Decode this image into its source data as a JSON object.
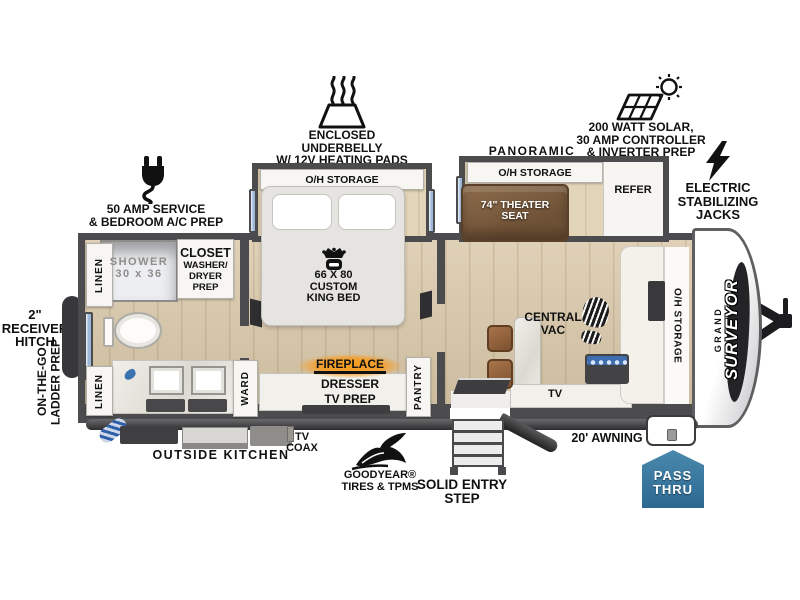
{
  "callouts": {
    "amp_service": {
      "l1": "50 AMP SERVICE",
      "l2": "& BEDROOM A/C PREP"
    },
    "underbelly": {
      "l1": "ENCLOSED UNDERBELLY",
      "l2": "W/ 12V HEATING PADS"
    },
    "solar": {
      "l1": "200 WATT SOLAR,",
      "l2": "30 AMP CONTROLLER",
      "l3": "& INVERTER PREP"
    },
    "panoramic_window": "PANORAMIC WINDOW",
    "stabilizing_jacks": {
      "l1": "ELECTRIC",
      "l2": "STABILIZING",
      "l3": "JACKS"
    },
    "receiver_hitch": {
      "l1": "2\" RECEIVER",
      "l2": "HITCH"
    },
    "ladder_prep": {
      "l1": "ON-THE-GO",
      "l2": "LADDER PREP"
    },
    "outside_kitchen": "OUTSIDE KITCHEN",
    "tv_coax": {
      "l1": "TV",
      "l2": "COAX"
    },
    "goodyear": {
      "l1": "GOODYEAR®",
      "l2": "TIRES & TPMS"
    },
    "entry_step": {
      "l1": "SOLID ENTRY",
      "l2": "STEP"
    },
    "awning": "20' AWNING",
    "pass_thru": {
      "l1": "PASS",
      "l2": "THRU"
    }
  },
  "bathroom": {
    "linen_top": "LINEN",
    "linen_bottom": "LINEN",
    "shower": {
      "l1": "SHOWER",
      "l2": "30 x 36"
    },
    "closet": {
      "l1": "CLOSET",
      "l2": "WASHER/",
      "l3": "DRYER PREP"
    }
  },
  "bedroom": {
    "oh_storage": "O/H STORAGE",
    "bed": {
      "l1": "66 X 80",
      "l2": "CUSTOM",
      "l3": "KING BED"
    },
    "ward": "WARD",
    "pantry": "PANTRY",
    "fireplace": "FIREPLACE",
    "dresser": "DRESSER",
    "tv_prep": "TV PREP"
  },
  "living": {
    "oh_storage": "O/H STORAGE",
    "theater_seat": {
      "l1": "74\" THEATER",
      "l2": "SEAT"
    },
    "refer": "REFER",
    "central_vac": {
      "l1": "CENTRAL",
      "l2": "VAC"
    },
    "tv": "TV",
    "front_oh_storage": "O/H STORAGE"
  },
  "brand": {
    "grand": "GRAND",
    "surveyor": "SURVEYOR"
  },
  "colors": {
    "wall": "#4c4c4e",
    "floor_tan": "#d8c6a7",
    "window_blue": "#9db8d8",
    "seat_brown": "#7d5f43",
    "fireplace_orange": "#f6921e",
    "pass_thru_blue": "#3579a3"
  }
}
